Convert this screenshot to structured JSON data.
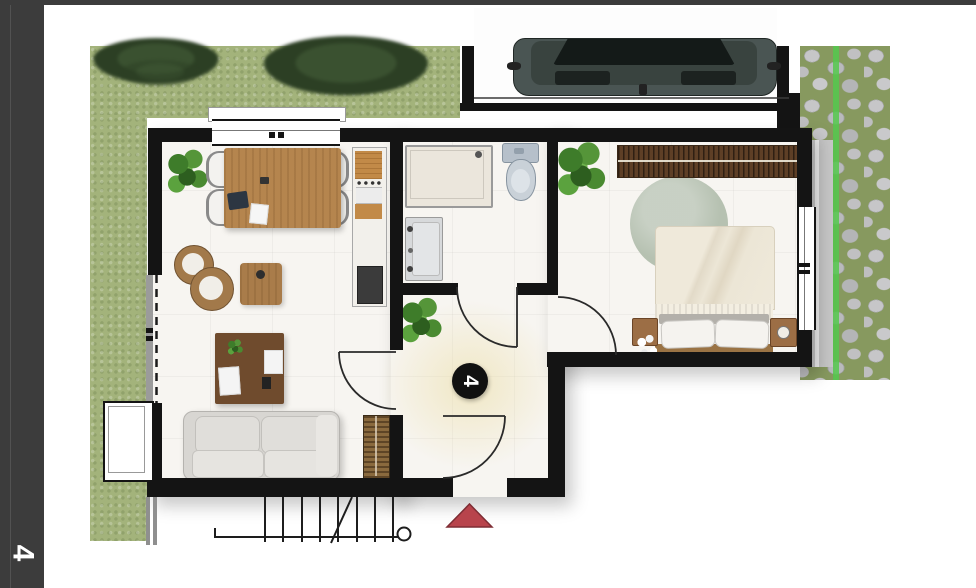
{
  "page": {
    "type": "floor-plan-sheet",
    "sheet_number": "4"
  },
  "sidebar": {
    "label": "4",
    "background": "#3c3c3c",
    "text_color": "#ffffff"
  },
  "plan": {
    "unit_marker": {
      "label": "4",
      "background": "#111111",
      "text_color": "#ffffff"
    },
    "entrance_arrow_color": "#b8444c",
    "colors": {
      "wall": "#141414",
      "floor": "#f7f5f1",
      "grass": "#a3b37b",
      "wood_furniture": "#b5854e",
      "dark_wood_desk": "#6f4b2d",
      "sofa": "#d8d6d2",
      "rug": "#b6c1b1",
      "headboard_panel": "#5e3f26",
      "cobblestone": "#b9babc",
      "path_line_green": "#55c84e",
      "toilet": "#c9d1d8",
      "car_body": "#4a5553"
    },
    "rooms": [
      {
        "name": "living-dining-room",
        "furniture": [
          "dining-table",
          "dining-chairs",
          "potted-plant",
          "lounge-stools",
          "side-table",
          "desk",
          "sofa",
          "radiator",
          "kitchenette-column",
          "sliding-glass-door",
          "lightwell-window"
        ]
      },
      {
        "name": "bathroom",
        "furniture": [
          "shower-tray",
          "toilet",
          "washbasin"
        ]
      },
      {
        "name": "hallway",
        "furniture": [
          "potted-plant",
          "unit-number-marker",
          "entrance-door"
        ]
      },
      {
        "name": "bedroom",
        "furniture": [
          "double-bed",
          "pillows",
          "nightstand-left",
          "nightstand-right",
          "round-rug",
          "headboard-slat-panel",
          "potted-plant",
          "flower-vase",
          "window"
        ]
      }
    ],
    "exterior": [
      "garden-lawn",
      "shrubs",
      "parking-space",
      "car",
      "cobblestone-path",
      "boundary-wall",
      "exterior-stairs",
      "entrance-triangle-marker"
    ]
  }
}
